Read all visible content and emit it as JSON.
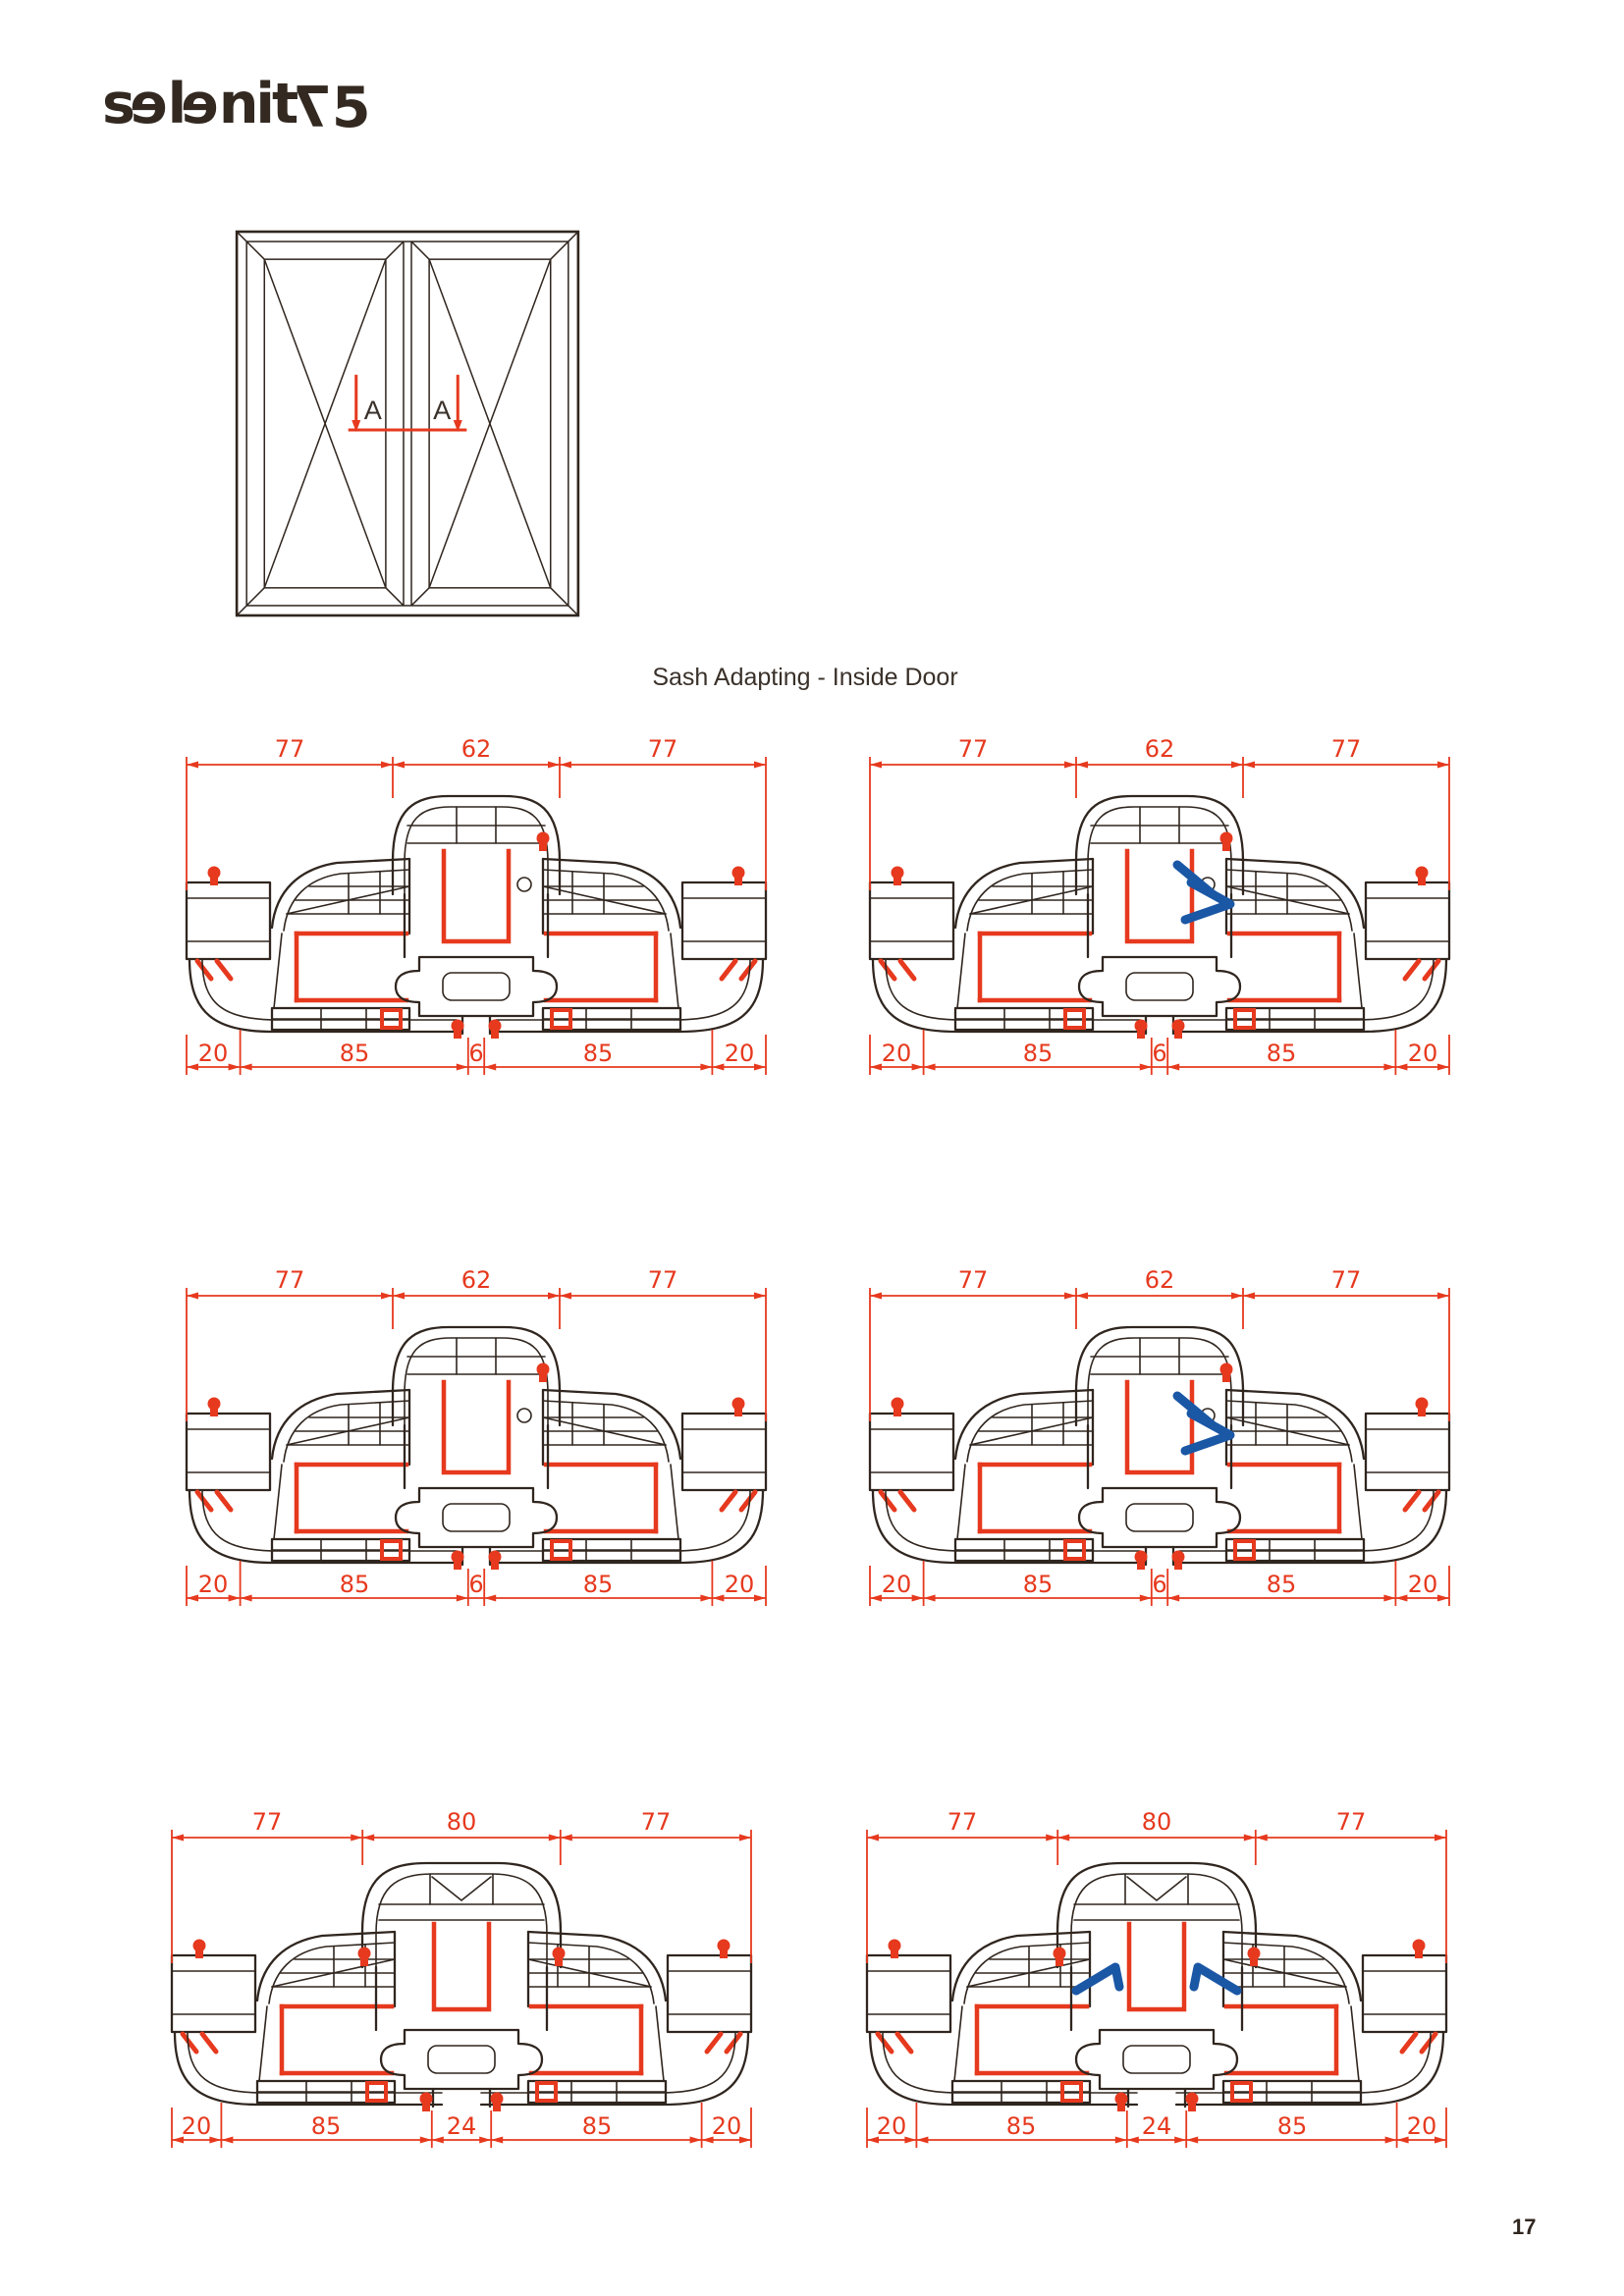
{
  "logo": {
    "brand": "selenit75",
    "letters": [
      {
        "ch": "s",
        "flip": false,
        "drop": false
      },
      {
        "ch": "e",
        "flip": true,
        "drop": false
      },
      {
        "ch": "l",
        "flip": false,
        "drop": false
      },
      {
        "ch": "e",
        "flip": true,
        "drop": false
      },
      {
        "ch": "n",
        "flip": false,
        "drop": false
      },
      {
        "ch": "i",
        "flip": false,
        "drop": false
      },
      {
        "ch": "t",
        "flip": false,
        "drop": false
      },
      {
        "ch": "7",
        "flip": true,
        "drop": true
      },
      {
        "ch": "5",
        "flip": false,
        "drop": true
      }
    ]
  },
  "title": "Sash Adapting - Inside Door",
  "window_diagram": {
    "section_labels": [
      "A",
      "A"
    ]
  },
  "sections": [
    {
      "name": "row1-left",
      "profile": "62",
      "connector": false,
      "top_dims": [
        "77",
        "62",
        "77"
      ],
      "bottom_dims": [
        "20",
        "85",
        "6",
        "85",
        "20"
      ]
    },
    {
      "name": "row1-right",
      "profile": "62",
      "connector": true,
      "top_dims": [
        "77",
        "62",
        "77"
      ],
      "bottom_dims": [
        "20",
        "85",
        "6",
        "85",
        "20"
      ]
    },
    {
      "name": "row2-left",
      "profile": "62",
      "connector": false,
      "top_dims": [
        "77",
        "62",
        "77"
      ],
      "bottom_dims": [
        "20",
        "85",
        "6",
        "85",
        "20"
      ]
    },
    {
      "name": "row2-right",
      "profile": "62",
      "connector": true,
      "top_dims": [
        "77",
        "62",
        "77"
      ],
      "bottom_dims": [
        "20",
        "85",
        "6",
        "85",
        "20"
      ]
    },
    {
      "name": "row3-left",
      "profile": "80",
      "connector": false,
      "top_dims": [
        "77",
        "80",
        "77"
      ],
      "bottom_dims": [
        "20",
        "85",
        "24",
        "85",
        "20"
      ]
    },
    {
      "name": "row3-right",
      "profile": "80",
      "connector": true,
      "top_dims": [
        "77",
        "80",
        "77"
      ],
      "bottom_dims": [
        "20",
        "85",
        "24",
        "85",
        "20"
      ]
    }
  ],
  "page_number": "17",
  "colors": {
    "dimension_red": "#e6391e",
    "profile_dark": "#30261f",
    "connector_blue": "#1a57a5"
  }
}
